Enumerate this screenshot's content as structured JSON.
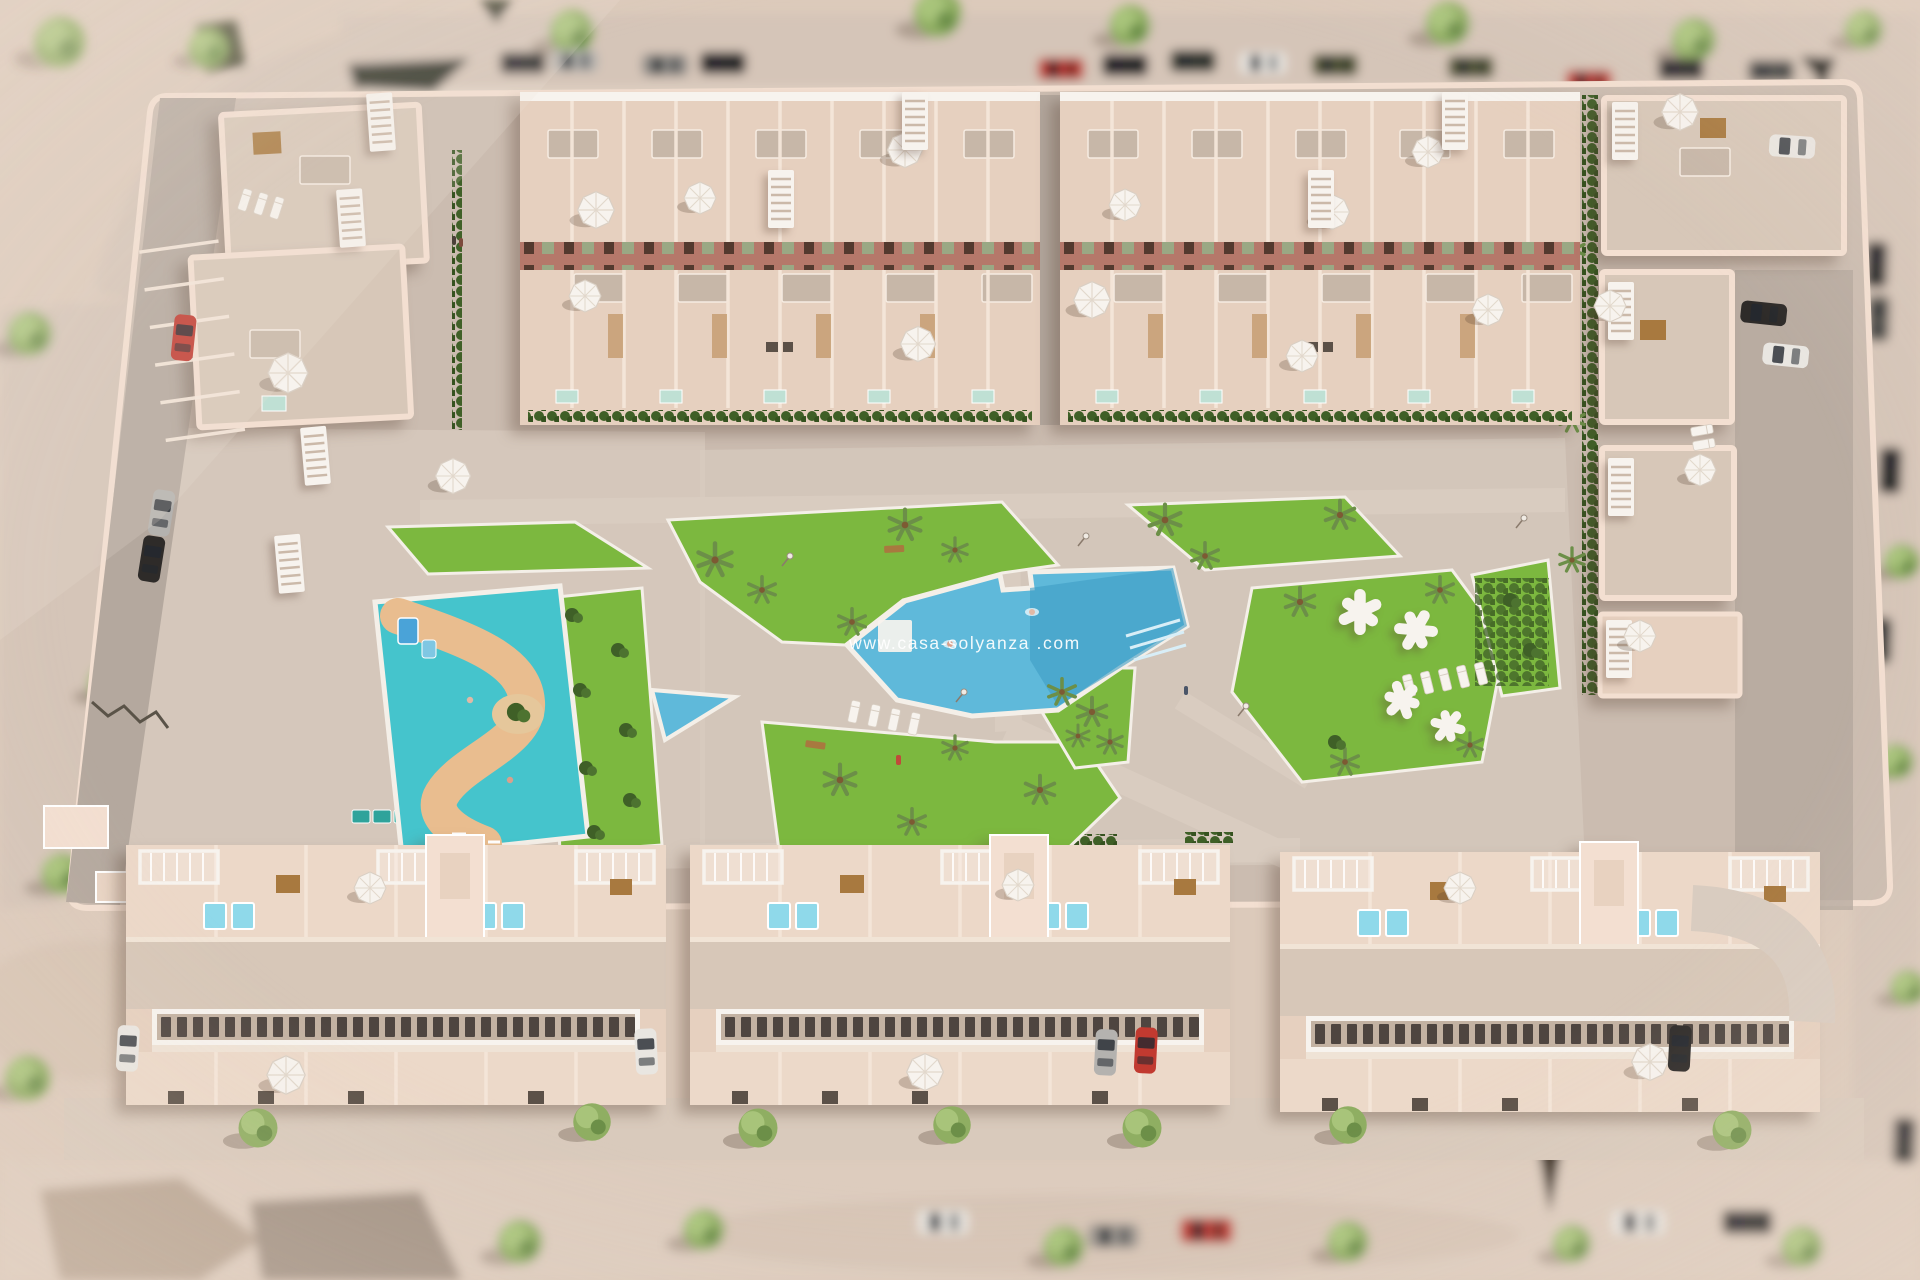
{
  "watermark": "www.casa-solyanza .com",
  "palette": {
    "sand": "#dccabb",
    "road": "#d5c5b8",
    "paving": "#cbbcb0",
    "lane": "#b4a89e",
    "path": "#d9ccc0",
    "wall": "#f3dfd1",
    "terrace": "#e6d0bf",
    "roof": "#d7c7b8",
    "roof_dark": "#c7b7a8",
    "facade_band": "#b5786a",
    "window_dark": "#4e4540",
    "shutter_green": "#9aa884",
    "lawn": "#7cb83f",
    "hedge": "#3f6027",
    "pool": "#5fb9da",
    "pool_deep": "#3d9cc4",
    "plunge": "#8fd9ea",
    "kids_pool": "#45c4cc",
    "sand_path": "#e9bd8f",
    "white": "#f7f3ee",
    "tree": "#8fae62",
    "tree_dark": "#6c8f48",
    "wood": "#a8793f",
    "car_red": "#c13a30",
    "car_white": "#e9e6e1",
    "car_silver": "#b4b2af",
    "car_black": "#2e2b29",
    "car_olive": "#565a38"
  }
}
